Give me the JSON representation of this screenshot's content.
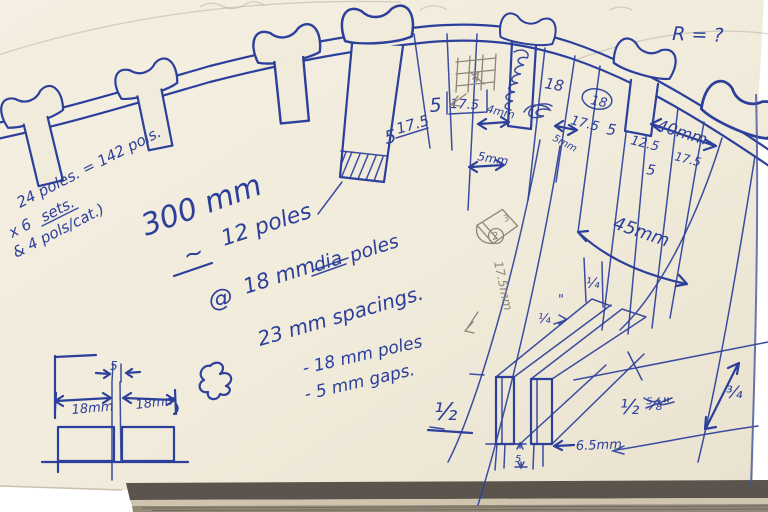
{
  "page": {
    "paper_color": "#f1ebdb",
    "ink_color": "#2b3f9b",
    "pencil_color": "#8d8577"
  },
  "top_right_note": "R = ?",
  "tally": {
    "line1": "24 poles. = 142 pols.",
    "line2_prefix": "x 6",
    "line2_struck": "sets.",
    "line3": "& 4 pols/cat.)"
  },
  "notes": {
    "total_width": "300 mm",
    "approx": "~",
    "pole_count": "12 poles",
    "at": "@",
    "pole_dia_pre": "18 mm",
    "pole_dia_struck": "dia",
    "pole_dia_post": "poles",
    "spacing": "23 mm spacings.",
    "sub1": "- 18 mm poles",
    "sub2": "- 5 mm gaps."
  },
  "top_dims": {
    "gap5_a": "5",
    "pole17_5_a": "17.5",
    "gap5_b": "5",
    "pole17_5_boxed": "17.5",
    "pencil4": "4",
    "gap4mm": "4mm",
    "gap5mm_a": "5mm",
    "pole18_a": "18",
    "pole17_5_b": "17.5",
    "gap5mm_b": "5mm",
    "pole18_circled": "18",
    "gap5_c": "5",
    "dim12_5": "12.5",
    "width40": "40mm",
    "pole17_5_c": "17.5",
    "gap5_d": "5",
    "width45": "45mm"
  },
  "pencil_note": "17.5mm",
  "dice": {
    "top_face": "3",
    "front_face": "2"
  },
  "slat_dims": {
    "quarter_a": "¼",
    "quarter_b": "¼",
    "ditto": "\"",
    "half_a": "½",
    "half_b": "½",
    "five_eighth": "⅝\"",
    "three_quarter": "¾",
    "width65": "6.5mm",
    "base_gap": "5"
  },
  "bottom_left_dims": {
    "gap": "5",
    "left_pole": "18mm",
    "right_pole": "18mm"
  }
}
